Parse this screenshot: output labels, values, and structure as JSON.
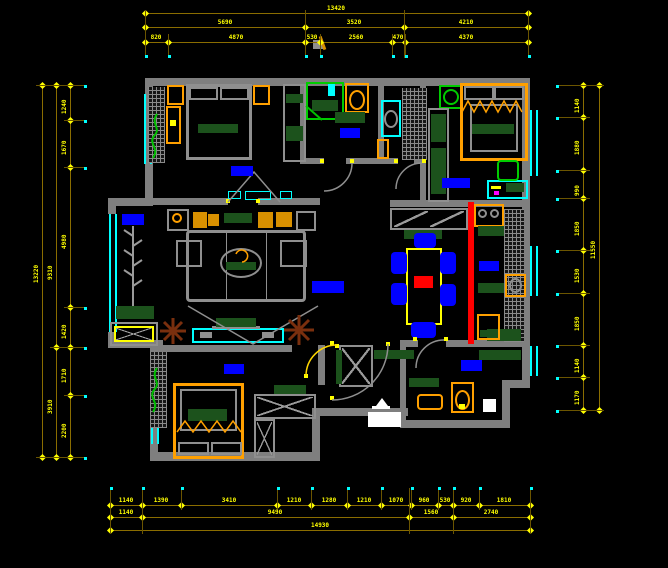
{
  "title": "apartment-floor-plan-cad",
  "colors": {
    "background": "#000000",
    "wall_gray": "#7f7f7f",
    "dim_line_olive": "#8a6d00",
    "dim_text_yellow": "#ffff00",
    "window_cyan": "#00ffff",
    "label_blue": "#0000ff",
    "furniture_orange": "#ffa000",
    "cushion_dark_green": "#1c521c",
    "fixture_green": "#00cc00",
    "duct_red": "#ff0000",
    "plant_brown": "#7a2f0e",
    "entry_white": "#ffffff"
  },
  "dimensions": {
    "top": [
      {
        "y": 13,
        "x1": 145,
        "x2": 528,
        "ticks": [
          145,
          528
        ],
        "labels": [
          {
            "x": 336,
            "t": "13420"
          }
        ]
      },
      {
        "y": 27,
        "x1": 145,
        "x2": 528,
        "ticks": [
          145,
          305,
          404,
          528
        ],
        "labels": [
          {
            "x": 225,
            "t": "5690"
          },
          {
            "x": 354,
            "t": "3520"
          },
          {
            "x": 466,
            "t": "4210"
          }
        ]
      },
      {
        "y": 42,
        "x1": 145,
        "x2": 528,
        "ticks": [
          145,
          168,
          305,
          320,
          392,
          405,
          528
        ],
        "labels": [
          {
            "x": 156,
            "t": "820"
          },
          {
            "x": 236,
            "t": "4870"
          },
          {
            "x": 312,
            "t": "530"
          },
          {
            "x": 356,
            "t": "2560"
          },
          {
            "x": 398,
            "t": "470"
          },
          {
            "x": 466,
            "t": "4370"
          }
        ]
      }
    ],
    "bottom": [
      {
        "y": 505,
        "x1": 110,
        "x2": 530,
        "ticks": [
          110,
          142,
          181,
          277,
          311,
          347,
          381,
          411,
          438,
          453,
          479,
          530
        ],
        "labels": [
          {
            "x": 126,
            "t": "1140"
          },
          {
            "x": 161,
            "t": "1390"
          },
          {
            "x": 229,
            "t": "3410"
          },
          {
            "x": 294,
            "t": "1210"
          },
          {
            "x": 329,
            "t": "1280"
          },
          {
            "x": 364,
            "t": "1210"
          },
          {
            "x": 396,
            "t": "1070"
          },
          {
            "x": 424,
            "t": "960"
          },
          {
            "x": 445,
            "t": "530"
          },
          {
            "x": 466,
            "t": "920"
          },
          {
            "x": 504,
            "t": "1810"
          }
        ]
      },
      {
        "y": 517,
        "x1": 110,
        "x2": 530,
        "ticks": [
          110,
          142,
          409,
          453,
          530
        ],
        "labels": [
          {
            "x": 126,
            "t": "1140"
          },
          {
            "x": 275,
            "t": "9490"
          },
          {
            "x": 431,
            "t": "1560"
          },
          {
            "x": 491,
            "t": "2740"
          }
        ]
      },
      {
        "y": 530,
        "x1": 110,
        "x2": 530,
        "ticks": [
          110,
          530
        ],
        "labels": [
          {
            "x": 320,
            "t": "14930"
          }
        ]
      }
    ],
    "left": [
      {
        "x": 42,
        "y1": 85,
        "y2": 457,
        "ticks": [
          85,
          457
        ],
        "labels": [
          {
            "y": 271,
            "t": "13220"
          }
        ]
      },
      {
        "x": 56,
        "y1": 85,
        "y2": 457,
        "ticks": [
          85,
          347,
          457
        ],
        "labels": [
          {
            "y": 268,
            "t": "9310"
          },
          {
            "y": 402,
            "t": "3910"
          }
        ]
      },
      {
        "x": 70,
        "y1": 85,
        "y2": 457,
        "ticks": [
          85,
          120,
          167,
          307,
          347,
          395,
          457
        ],
        "labels": [
          {
            "y": 102,
            "t": "1240"
          },
          {
            "y": 143,
            "t": "1670"
          },
          {
            "y": 237,
            "t": "4980"
          },
          {
            "y": 327,
            "t": "1420"
          },
          {
            "y": 371,
            "t": "1710"
          },
          {
            "y": 426,
            "t": "2200"
          }
        ]
      }
    ],
    "right": [
      {
        "x": 583,
        "y1": 85,
        "y2": 410,
        "ticks": [
          85,
          117,
          170,
          198,
          250,
          293,
          345,
          377,
          410
        ],
        "labels": [
          {
            "y": 101,
            "t": "1140"
          },
          {
            "y": 143,
            "t": "1880"
          },
          {
            "y": 184,
            "t": "990"
          },
          {
            "y": 224,
            "t": "1850"
          },
          {
            "y": 271,
            "t": "1530"
          },
          {
            "y": 319,
            "t": "1850"
          },
          {
            "y": 361,
            "t": "1140"
          },
          {
            "y": 393,
            "t": "1170"
          }
        ]
      },
      {
        "x": 599,
        "y1": 85,
        "y2": 410,
        "ticks": [
          85,
          410
        ],
        "labels": [
          {
            "y": 247,
            "t": "11550"
          }
        ]
      }
    ],
    "ext_v": [
      {
        "x": 145,
        "y1": 10,
        "y2": 58
      },
      {
        "x": 305,
        "y1": 10,
        "y2": 58
      },
      {
        "x": 404,
        "y1": 10,
        "y2": 58
      },
      {
        "x": 528,
        "y1": 10,
        "y2": 58
      },
      {
        "x": 168,
        "y1": 34,
        "y2": 58
      },
      {
        "x": 320,
        "y1": 34,
        "y2": 58
      },
      {
        "x": 392,
        "y1": 34,
        "y2": 58
      },
      {
        "x": 405,
        "y1": 34,
        "y2": 58
      },
      {
        "x": 110,
        "y1": 488,
        "y2": 534
      },
      {
        "x": 142,
        "y1": 488,
        "y2": 534
      },
      {
        "x": 409,
        "y1": 488,
        "y2": 534
      },
      {
        "x": 453,
        "y1": 488,
        "y2": 534
      },
      {
        "x": 530,
        "y1": 488,
        "y2": 534
      },
      {
        "x": 181,
        "y1": 488,
        "y2": 510
      },
      {
        "x": 277,
        "y1": 488,
        "y2": 510
      },
      {
        "x": 311,
        "y1": 488,
        "y2": 510
      },
      {
        "x": 347,
        "y1": 488,
        "y2": 510
      },
      {
        "x": 381,
        "y1": 488,
        "y2": 510
      },
      {
        "x": 411,
        "y1": 488,
        "y2": 510
      },
      {
        "x": 438,
        "y1": 488,
        "y2": 510
      },
      {
        "x": 479,
        "y1": 488,
        "y2": 510
      }
    ],
    "ext_h": [
      {
        "y": 85,
        "x1": 36,
        "x2": 84
      },
      {
        "y": 457,
        "x1": 36,
        "x2": 84
      },
      {
        "y": 347,
        "x1": 50,
        "x2": 84
      },
      {
        "y": 120,
        "x1": 64,
        "x2": 84
      },
      {
        "y": 167,
        "x1": 64,
        "x2": 84
      },
      {
        "y": 307,
        "x1": 64,
        "x2": 84
      },
      {
        "y": 395,
        "x1": 64,
        "x2": 84
      },
      {
        "y": 85,
        "x1": 556,
        "x2": 604
      },
      {
        "y": 410,
        "x1": 556,
        "x2": 604
      },
      {
        "y": 117,
        "x1": 556,
        "x2": 590
      },
      {
        "y": 170,
        "x1": 556,
        "x2": 590
      },
      {
        "y": 198,
        "x1": 556,
        "x2": 590
      },
      {
        "y": 250,
        "x1": 556,
        "x2": 590
      },
      {
        "y": 293,
        "x1": 556,
        "x2": 590
      },
      {
        "y": 345,
        "x1": 556,
        "x2": 590
      },
      {
        "y": 377,
        "x1": 556,
        "x2": 590
      }
    ],
    "dots": [
      {
        "x": 145,
        "y": 55
      },
      {
        "x": 168,
        "y": 55
      },
      {
        "x": 305,
        "y": 55
      },
      {
        "x": 320,
        "y": 55
      },
      {
        "x": 392,
        "y": 55
      },
      {
        "x": 405,
        "y": 55
      },
      {
        "x": 528,
        "y": 55
      },
      {
        "x": 110,
        "y": 487
      },
      {
        "x": 142,
        "y": 487
      },
      {
        "x": 181,
        "y": 487
      },
      {
        "x": 277,
        "y": 487
      },
      {
        "x": 311,
        "y": 487
      },
      {
        "x": 347,
        "y": 487
      },
      {
        "x": 381,
        "y": 487
      },
      {
        "x": 411,
        "y": 487
      },
      {
        "x": 438,
        "y": 487
      },
      {
        "x": 453,
        "y": 487
      },
      {
        "x": 479,
        "y": 487
      },
      {
        "x": 530,
        "y": 487
      },
      {
        "x": 84,
        "y": 85
      },
      {
        "x": 84,
        "y": 120
      },
      {
        "x": 84,
        "y": 167
      },
      {
        "x": 84,
        "y": 307
      },
      {
        "x": 84,
        "y": 347
      },
      {
        "x": 84,
        "y": 395
      },
      {
        "x": 84,
        "y": 457
      },
      {
        "x": 556,
        "y": 85
      },
      {
        "x": 556,
        "y": 117
      },
      {
        "x": 556,
        "y": 170
      },
      {
        "x": 556,
        "y": 198
      },
      {
        "x": 556,
        "y": 250
      },
      {
        "x": 556,
        "y": 293
      },
      {
        "x": 556,
        "y": 345
      },
      {
        "x": 556,
        "y": 377
      },
      {
        "x": 556,
        "y": 410
      }
    ]
  },
  "room_labels": [
    {
      "name": "bedroom-1",
      "x": 231,
      "y": 166,
      "w": 22,
      "h": 10
    },
    {
      "name": "bathroom-1",
      "x": 340,
      "y": 128,
      "w": 20,
      "h": 10
    },
    {
      "name": "bedroom-2",
      "x": 442,
      "y": 178,
      "w": 28,
      "h": 10
    },
    {
      "name": "bay-window",
      "x": 122,
      "y": 214,
      "w": 22,
      "h": 11
    },
    {
      "name": "living-room",
      "x": 312,
      "y": 281,
      "w": 32,
      "h": 12
    },
    {
      "name": "kitchen",
      "x": 479,
      "y": 261,
      "w": 20,
      "h": 10
    },
    {
      "name": "bedroom-3",
      "x": 224,
      "y": 364,
      "w": 20,
      "h": 10
    },
    {
      "name": "bathroom-2",
      "x": 461,
      "y": 360,
      "w": 21,
      "h": 11
    }
  ]
}
